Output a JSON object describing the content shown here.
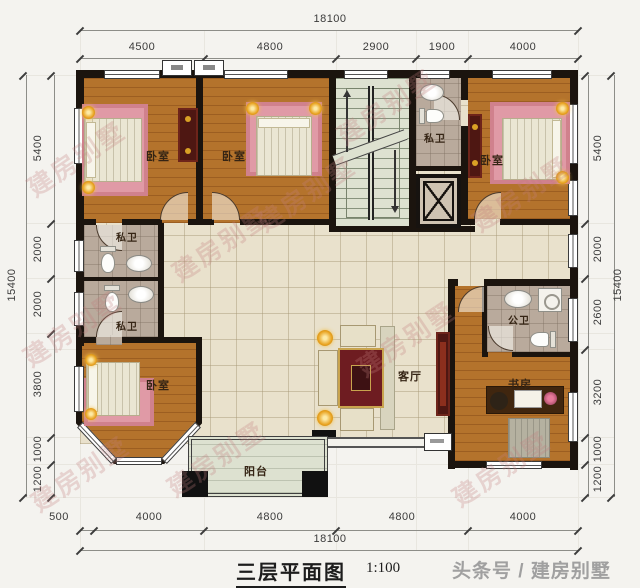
{
  "title": {
    "text": "三层平面图",
    "scale": "1:100"
  },
  "credit": "头条号 / 建房别墅",
  "watermark": "建房别墅",
  "dimensions": {
    "top": {
      "total": "18100",
      "segments": [
        "4500",
        "4800",
        "2900",
        "1900",
        "4000"
      ]
    },
    "bottom": {
      "total": "18100",
      "segments": [
        "500",
        "4000",
        "4800",
        "4800",
        "4000"
      ]
    },
    "left": {
      "total": "15400",
      "segments": [
        "5400",
        "2000",
        "2000",
        "3800",
        "1000",
        "1200"
      ]
    },
    "right": {
      "total": "15400",
      "segments": [
        "5400",
        "2000",
        "2600",
        "3200",
        "1000",
        "1200"
      ]
    }
  },
  "rooms": {
    "bedroom_top_left": "卧室",
    "bedroom_top_middle": "卧室",
    "bedroom_top_right": "卧室",
    "bedroom_bottom_left": "卧室",
    "bath_top": "私卫",
    "bath_left_upper": "私卫",
    "bath_left_lower": "私卫",
    "bath_public": "公卫",
    "living_room": "客厅",
    "study": "书房",
    "balcony": "阳台"
  },
  "colors": {
    "wall": "#1b140e",
    "wood_floor": "#b4732c",
    "tile_floor": "#e9e1cc",
    "bath_floor": "#b9aa9c",
    "stair_floor": "#dde1d0",
    "bed_mat_pink": "#e09aa6",
    "cabinet_maroon": "#4e1712",
    "rug_red": "#6e1c21",
    "lamp_gold": "#e8a21f"
  }
}
